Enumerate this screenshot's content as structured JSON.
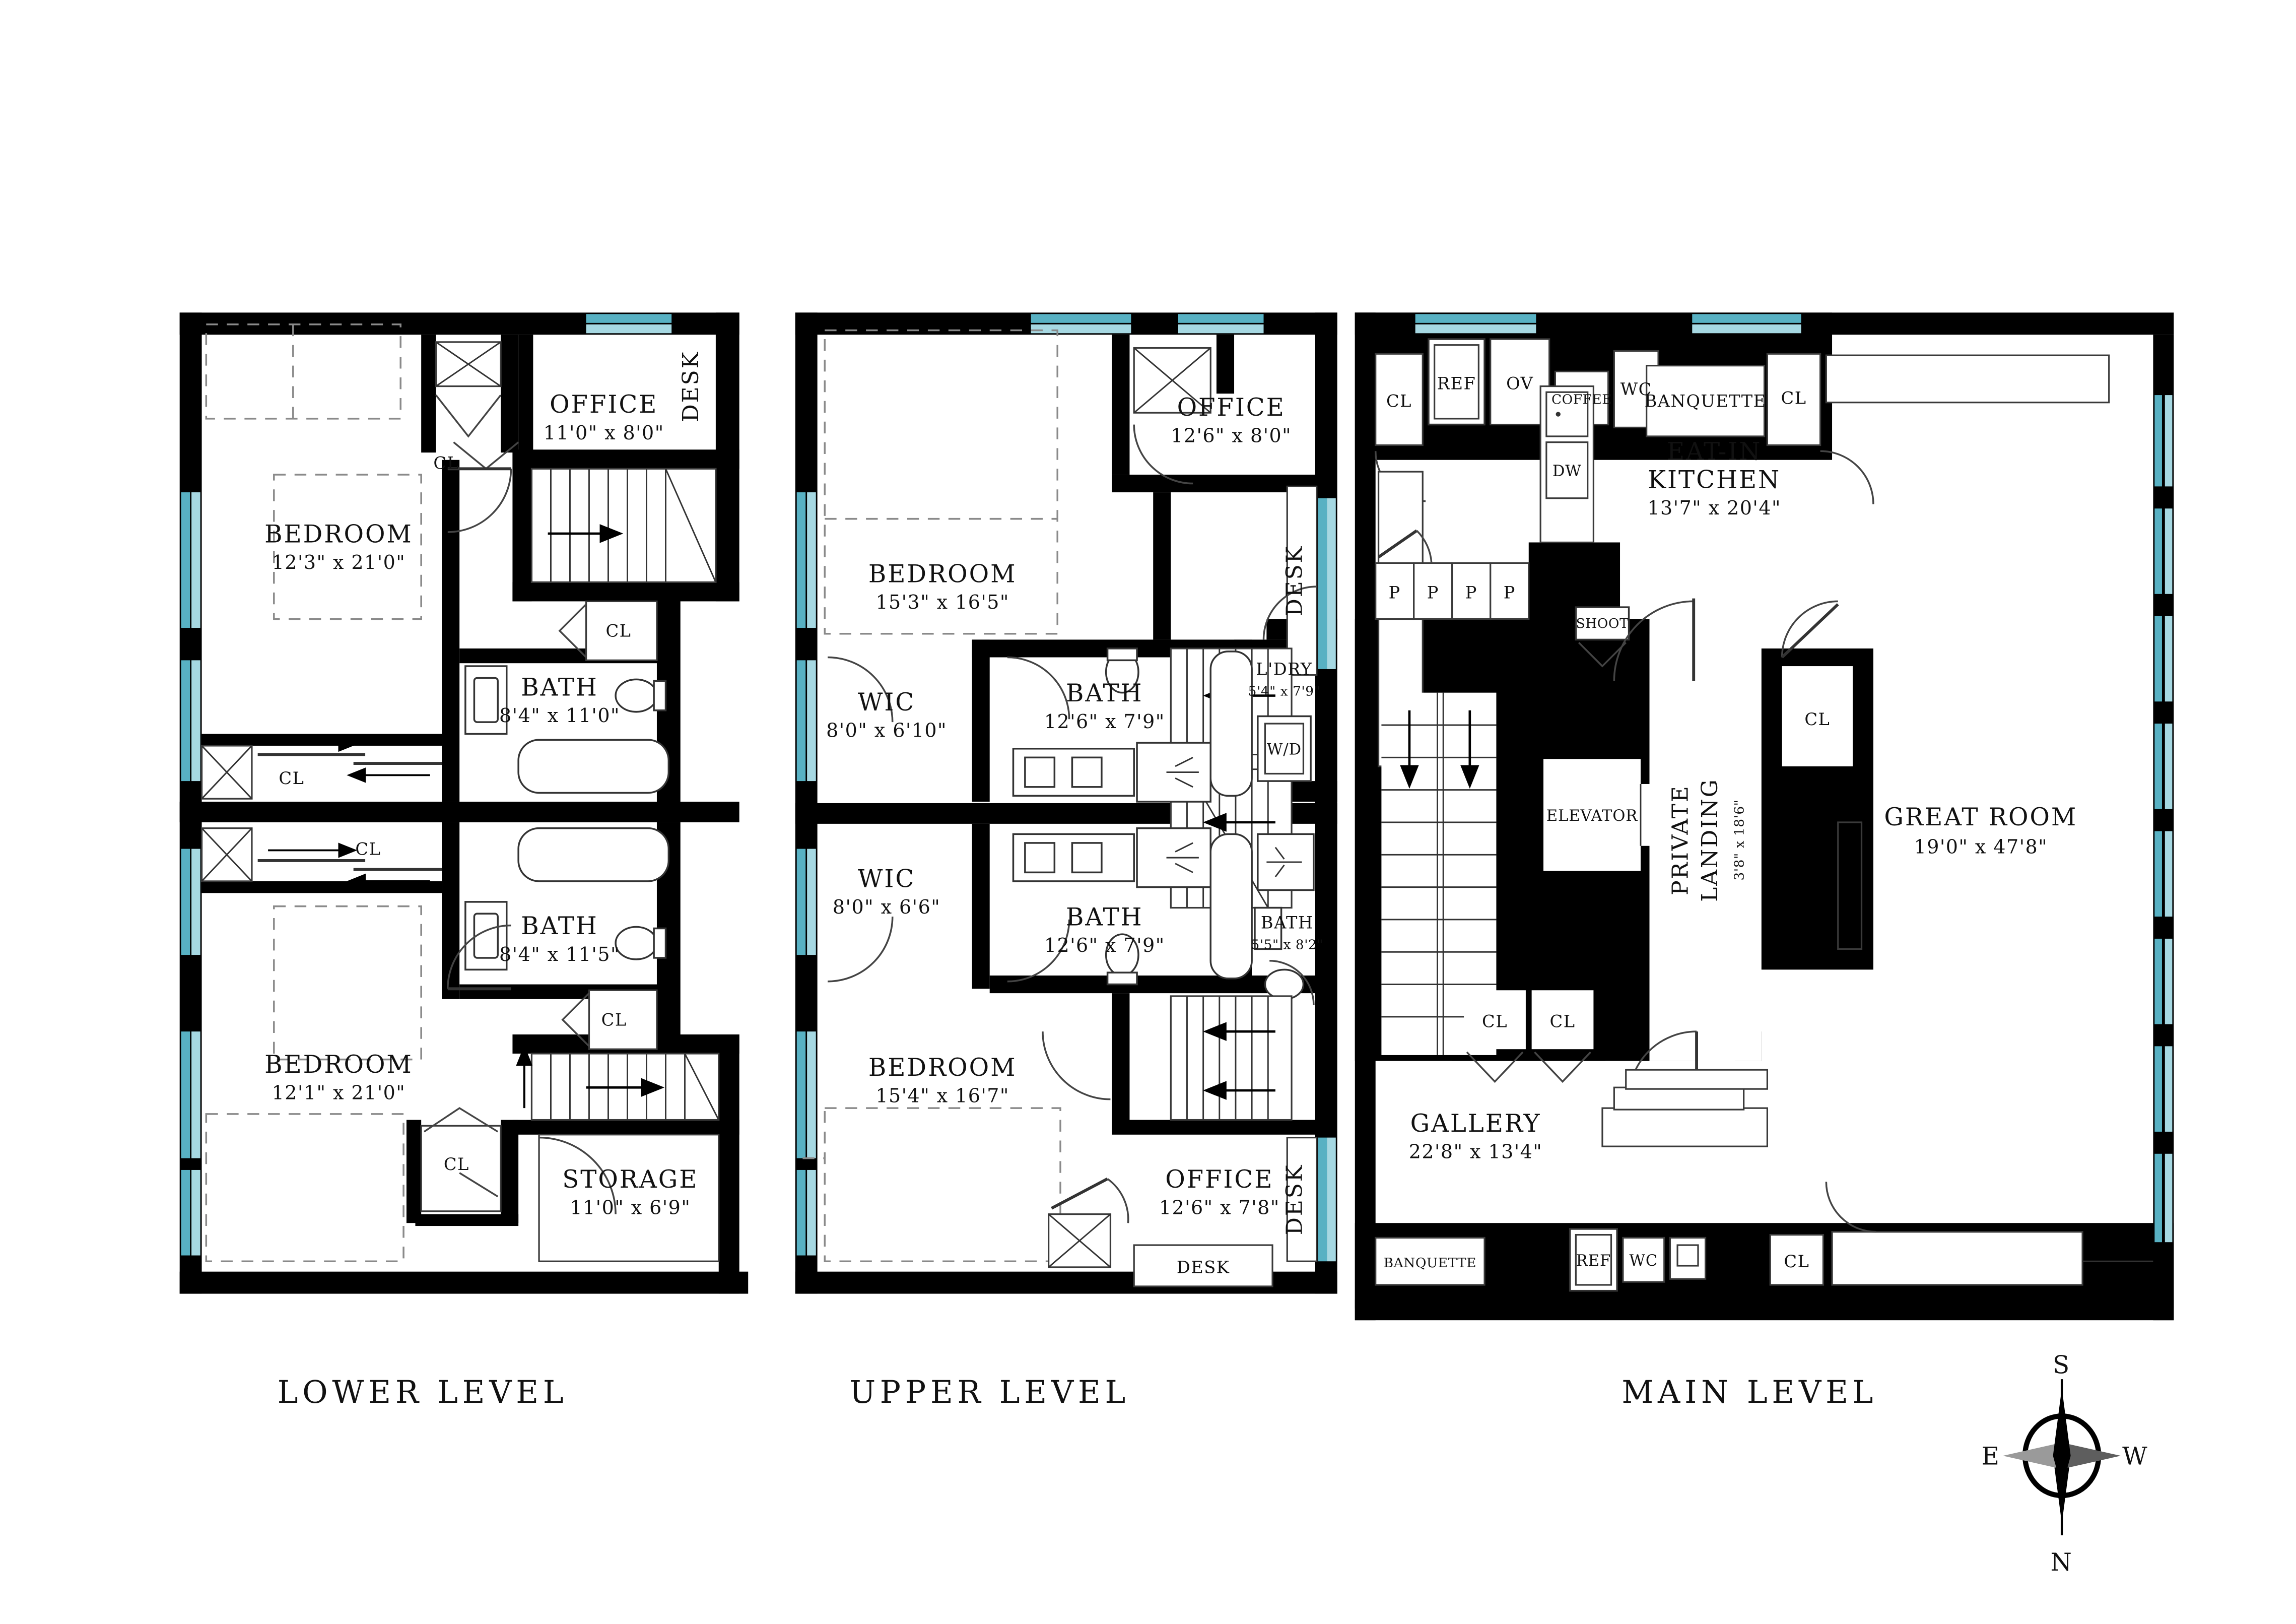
{
  "document": {
    "type": "residential floor plan, 3 levels"
  },
  "colors": {
    "wall": "#000000",
    "glass_dark": "#58b1c3",
    "glass_light": "#a6d8e2",
    "paper": "#ffffff"
  },
  "compass": {
    "n": "N",
    "s": "S",
    "e": "E",
    "w": "W"
  },
  "plans": {
    "lower": {
      "title": "LOWER LEVEL",
      "rooms": {
        "bedroom1": {
          "name": "BEDROOM",
          "dims": "12'3\" x 21'0\""
        },
        "office": {
          "name": "OFFICE",
          "dims": "11'0\" x 8'0\""
        },
        "desk": {
          "name": "DESK"
        },
        "bath1": {
          "name": "BATH",
          "dims": "8'4\" x 11'0\""
        },
        "bath2": {
          "name": "BATH",
          "dims": "8'4\" x 11'5\""
        },
        "bedroom2": {
          "name": "BEDROOM",
          "dims": "12'1\" x 21'0\""
        },
        "storage": {
          "name": "STORAGE",
          "dims": "11'0\" x 6'9\""
        }
      },
      "closets": [
        "CL",
        "CL",
        "CL",
        "CL",
        "CL",
        "CL"
      ]
    },
    "upper": {
      "title": "UPPER LEVEL",
      "rooms": {
        "office1": {
          "name": "OFFICE",
          "dims": "12'6\" x 8'0\""
        },
        "desk1": {
          "name": "DESK"
        },
        "bedroom1": {
          "name": "BEDROOM",
          "dims": "15'3\" x 16'5\""
        },
        "wic1": {
          "name": "WIC",
          "dims": "8'0\" x 6'10\""
        },
        "bath1": {
          "name": "BATH",
          "dims": "12'6\" x 7'9\""
        },
        "ldry": {
          "name": "L'DRY",
          "dims": "5'4\" x 7'9\"",
          "wd": "W/D"
        },
        "wic2": {
          "name": "WIC",
          "dims": "8'0\" x 6'6\""
        },
        "bath2": {
          "name": "BATH",
          "dims": "12'6\" x 7'9\""
        },
        "bath3": {
          "name": "BATH",
          "dims": "5'5\" x 8'2\""
        },
        "bedroom2": {
          "name": "BEDROOM",
          "dims": "15'4\" x 16'7\""
        },
        "office2": {
          "name": "OFFICE",
          "dims": "12'6\" x 7'8\""
        },
        "desk2": {
          "name": "DESK"
        },
        "desk3": {
          "name": "DESK"
        }
      }
    },
    "main": {
      "title": "MAIN LEVEL",
      "rooms": {
        "kitchen": {
          "name1": "EAT-IN",
          "name2": "KITCHEN",
          "dims": "13'7\" x 20'4\""
        },
        "greatroom": {
          "name": "GREAT ROOM",
          "dims": "19'0\" x 47'8\""
        },
        "gallery": {
          "name": "GALLERY",
          "dims": "22'8\" x 13'4\""
        },
        "landing": {
          "name1": "PRIVATE",
          "name2": "LANDING",
          "dims": "3'8\" x 18'6\""
        },
        "elevator": {
          "name": "ELEVATOR"
        }
      },
      "appliances": {
        "ref_top": "REF",
        "ov": "OV",
        "coffee": "COFFEE",
        "wc_top": "WC",
        "dw": "DW",
        "banquette_top": "BANQUETTE",
        "banquette_bottom": "BANQUETTE",
        "ref_bottom": "REF",
        "wc_bottom": "WC",
        "shoot": "SHOOT"
      },
      "pantry": [
        "P",
        "P",
        "P",
        "P"
      ],
      "closets": [
        "CL",
        "CL",
        "CL",
        "CL",
        "CL",
        "CL"
      ]
    }
  }
}
